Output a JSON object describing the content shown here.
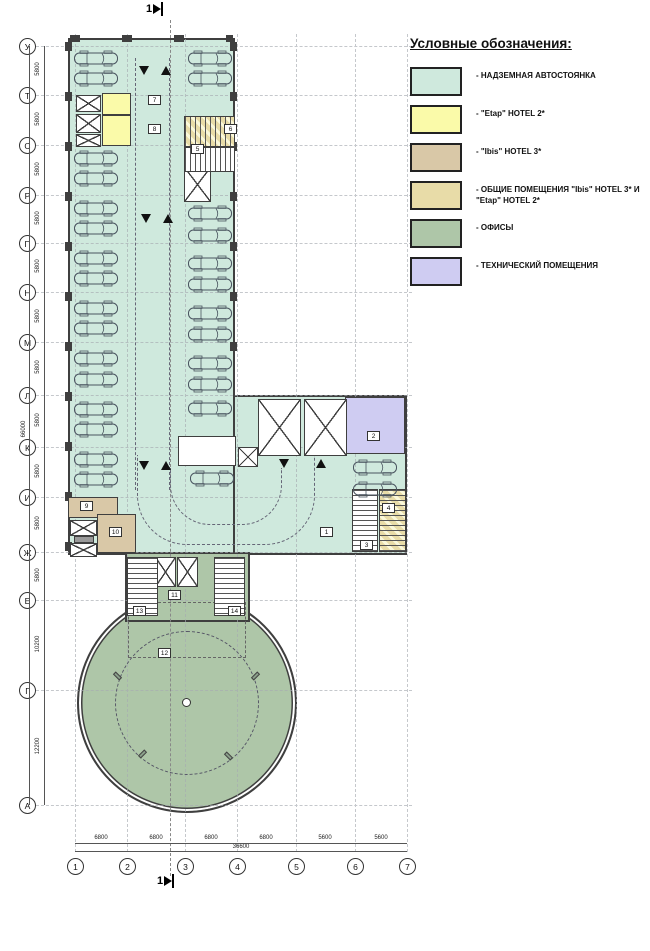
{
  "legend": {
    "title": "Условные обозначения:",
    "items": [
      {
        "label": "- НАДЗЕМНАЯ АВТОСТОЯНКА",
        "key": "parking",
        "style": "solid"
      },
      {
        "label": "- \"Etap\" HOTEL 2*",
        "key": "etap",
        "style": "solid"
      },
      {
        "label": "- \"Ibis\" HOTEL 3*",
        "key": "ibis",
        "style": "solid"
      },
      {
        "label": "- ОБЩИЕ ПОМЕЩЕНИЯ \"Ibis\" HOTEL 3* И \"Etap\" HOTEL 2*",
        "key": "shared",
        "style": "hatch"
      },
      {
        "label": "- ОФИСЫ",
        "key": "offices",
        "style": "solid"
      },
      {
        "label": "- ТЕХНИЧЕСКИЙ ПОМЕЩЕНИЯ",
        "key": "tech",
        "style": "solid"
      }
    ]
  },
  "colors": {
    "parking": "#cfe9dd",
    "etap": "#fafaa9",
    "ibis": "#d9c8a7",
    "shared": "#e8dca8",
    "offices": "#aec6a8",
    "tech": "#cfccf2",
    "walls": "#3f3f3f",
    "gray": "#9a9a9a",
    "white": "#ffffff"
  },
  "section": {
    "label": "1"
  },
  "axes": {
    "rows": [
      {
        "label": "У",
        "y": 46
      },
      {
        "label": "Т",
        "y": 95
      },
      {
        "label": "С",
        "y": 145
      },
      {
        "label": "Р",
        "y": 195
      },
      {
        "label": "П",
        "y": 243
      },
      {
        "label": "Н",
        "y": 292
      },
      {
        "label": "М",
        "y": 342
      },
      {
        "label": "Л",
        "y": 395
      },
      {
        "label": "К",
        "y": 447
      },
      {
        "label": "И",
        "y": 497
      },
      {
        "label": "Ж",
        "y": 552
      },
      {
        "label": "Е",
        "y": 600
      },
      {
        "label": "Г",
        "y": 690
      },
      {
        "label": "А",
        "y": 805
      }
    ],
    "cols": [
      {
        "label": "1",
        "x": 75
      },
      {
        "label": "2",
        "x": 127
      },
      {
        "label": "3",
        "x": 185
      },
      {
        "label": "4",
        "x": 237
      },
      {
        "label": "5",
        "x": 296
      },
      {
        "label": "6",
        "x": 355
      },
      {
        "label": "7",
        "x": 407
      }
    ]
  },
  "dims": {
    "left": [
      {
        "label": "5800",
        "y": 70
      },
      {
        "label": "5800",
        "y": 120
      },
      {
        "label": "5800",
        "y": 170
      },
      {
        "label": "5800",
        "y": 219
      },
      {
        "label": "5800",
        "y": 267
      },
      {
        "label": "5800",
        "y": 317
      },
      {
        "label": "5800",
        "y": 368
      },
      {
        "label": "5800",
        "y": 421
      },
      {
        "label": "5800",
        "y": 472
      },
      {
        "label": "5800",
        "y": 524
      },
      {
        "label": "5800",
        "y": 576
      },
      {
        "label": "10200",
        "y": 645
      },
      {
        "label": "12200",
        "y": 747
      }
    ],
    "left_total": {
      "label": "66000",
      "y": 430
    },
    "bottom": [
      {
        "label": "6800",
        "x": 101
      },
      {
        "label": "6800",
        "x": 156
      },
      {
        "label": "6800",
        "x": 211
      },
      {
        "label": "6800",
        "x": 266
      },
      {
        "label": "5600",
        "x": 325
      },
      {
        "label": "5600",
        "x": 381
      }
    ],
    "bottom_total": {
      "label": "36600",
      "x": 241
    }
  },
  "plan": {
    "rooms": [
      {
        "x": 102,
        "y": 93,
        "w": 29,
        "h": 22,
        "fill": "etap"
      },
      {
        "x": 102,
        "y": 115,
        "w": 29,
        "h": 31,
        "fill": "etap"
      },
      {
        "x": 345,
        "y": 397,
        "w": 60,
        "h": 57,
        "fill": "tech"
      },
      {
        "x": 68,
        "y": 497,
        "w": 50,
        "h": 21,
        "fill": "ibis"
      },
      {
        "x": 97,
        "y": 514,
        "w": 39,
        "h": 39,
        "fill": "ibis"
      },
      {
        "x": 178,
        "y": 436,
        "w": 58,
        "h": 30,
        "fill": "white"
      },
      {
        "x": 74,
        "y": 536,
        "w": 20,
        "h": 7,
        "fill": "gray"
      }
    ],
    "shafts": [
      {
        "x": 76,
        "y": 95,
        "w": 25,
        "h": 17
      },
      {
        "x": 76,
        "y": 114,
        "w": 25,
        "h": 19
      },
      {
        "x": 76,
        "y": 134,
        "w": 25,
        "h": 13
      },
      {
        "x": 184,
        "y": 167,
        "w": 27,
        "h": 35
      },
      {
        "x": 258,
        "y": 399,
        "w": 43,
        "h": 57
      },
      {
        "x": 304,
        "y": 399,
        "w": 43,
        "h": 57
      },
      {
        "x": 238,
        "y": 447,
        "w": 20,
        "h": 20
      },
      {
        "x": 70,
        "y": 520,
        "w": 27,
        "h": 16
      },
      {
        "x": 70,
        "y": 543,
        "w": 27,
        "h": 14
      },
      {
        "x": 155,
        "y": 557,
        "w": 21,
        "h": 30
      },
      {
        "x": 177,
        "y": 557,
        "w": 21,
        "h": 30
      }
    ],
    "stairs": [
      {
        "x": 184,
        "y": 116,
        "w": 51,
        "h": 31,
        "dir": "h",
        "hatch": true
      },
      {
        "x": 184,
        "y": 147,
        "w": 51,
        "h": 25,
        "dir": "h",
        "hatch": false
      },
      {
        "x": 352,
        "y": 489,
        "w": 26,
        "h": 63,
        "dir": "v",
        "hatch": false
      },
      {
        "x": 379,
        "y": 489,
        "w": 27,
        "h": 63,
        "dir": "v",
        "hatch": true
      },
      {
        "x": 127,
        "y": 557,
        "w": 31,
        "h": 59,
        "dir": "v",
        "hatch": false
      },
      {
        "x": 214,
        "y": 557,
        "w": 31,
        "h": 59,
        "dir": "v",
        "hatch": false
      }
    ],
    "cars": [
      {
        "x": 73,
        "y": 50
      },
      {
        "x": 73,
        "y": 70
      },
      {
        "x": 73,
        "y": 150
      },
      {
        "x": 73,
        "y": 170
      },
      {
        "x": 73,
        "y": 200
      },
      {
        "x": 73,
        "y": 220
      },
      {
        "x": 73,
        "y": 250
      },
      {
        "x": 73,
        "y": 270
      },
      {
        "x": 73,
        "y": 300
      },
      {
        "x": 73,
        "y": 320
      },
      {
        "x": 73,
        "y": 350
      },
      {
        "x": 73,
        "y": 371
      },
      {
        "x": 73,
        "y": 401
      },
      {
        "x": 73,
        "y": 421
      },
      {
        "x": 73,
        "y": 451
      },
      {
        "x": 73,
        "y": 471
      },
      {
        "x": 187,
        "y": 50
      },
      {
        "x": 187,
        "y": 70
      },
      {
        "x": 187,
        "y": 205
      },
      {
        "x": 187,
        "y": 227
      },
      {
        "x": 187,
        "y": 255
      },
      {
        "x": 187,
        "y": 276
      },
      {
        "x": 187,
        "y": 305
      },
      {
        "x": 187,
        "y": 326
      },
      {
        "x": 187,
        "y": 355
      },
      {
        "x": 187,
        "y": 376
      },
      {
        "x": 187,
        "y": 400
      },
      {
        "x": 189,
        "y": 470
      },
      {
        "x": 352,
        "y": 459
      },
      {
        "x": 352,
        "y": 481
      }
    ],
    "tags": [
      {
        "n": "7",
        "x": 148,
        "y": 95
      },
      {
        "n": "8",
        "x": 148,
        "y": 124
      },
      {
        "n": "6",
        "x": 224,
        "y": 124
      },
      {
        "n": "5",
        "x": 191,
        "y": 144
      },
      {
        "n": "2",
        "x": 367,
        "y": 431
      },
      {
        "n": "1",
        "x": 320,
        "y": 527
      },
      {
        "n": "9",
        "x": 80,
        "y": 501
      },
      {
        "n": "10",
        "x": 109,
        "y": 527
      },
      {
        "n": "3",
        "x": 360,
        "y": 540
      },
      {
        "n": "4",
        "x": 382,
        "y": 503
      },
      {
        "n": "11",
        "x": 168,
        "y": 590
      },
      {
        "n": "13",
        "x": 133,
        "y": 606
      },
      {
        "n": "14",
        "x": 228,
        "y": 606
      },
      {
        "n": "12",
        "x": 158,
        "y": 648
      }
    ],
    "arrows": [
      {
        "x": 139,
        "y": 66,
        "d": "down"
      },
      {
        "x": 161,
        "y": 66,
        "d": "up"
      },
      {
        "x": 141,
        "y": 214,
        "d": "down"
      },
      {
        "x": 163,
        "y": 214,
        "d": "up"
      },
      {
        "x": 139,
        "y": 461,
        "d": "down"
      },
      {
        "x": 161,
        "y": 461,
        "d": "up"
      },
      {
        "x": 279,
        "y": 459,
        "d": "down"
      },
      {
        "x": 316,
        "y": 459,
        "d": "up"
      }
    ]
  }
}
